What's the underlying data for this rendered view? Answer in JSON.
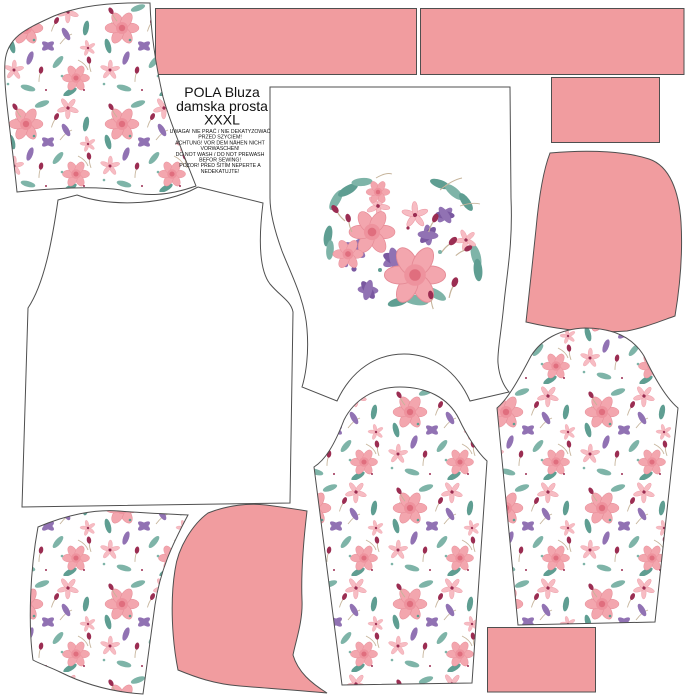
{
  "panel": {
    "title": {
      "line1": "POLA Bluza",
      "line2": "damska prosta",
      "line3": "XXXL"
    },
    "care_text": {
      "lines": [
        "UWAGA! NIE PRAĆ / NIE DEKATYZOWAĆ",
        "PRZED SZYCIEM!",
        "ACHTUNG! VOR DEM NÄHEN NICHT",
        "VORWASCHEN!",
        "DO NOT WASH / DO NOT PREWASH",
        "BEFOR SEWING!",
        "POZOR! PŘED ŠITÍM NEPERTE A",
        "NEDEKATUJTE!"
      ]
    }
  },
  "colors": {
    "background": "#ffffff",
    "fabric_pink": "#f19c9f",
    "outline_gray": "#4f4f4f",
    "rose_pink": "#f3a6ae",
    "rose_deep": "#e06e7e",
    "floral_purple": "#9172b3",
    "floral_teal": "#7eb4a8",
    "floral_burgundy": "#9b2d52"
  }
}
